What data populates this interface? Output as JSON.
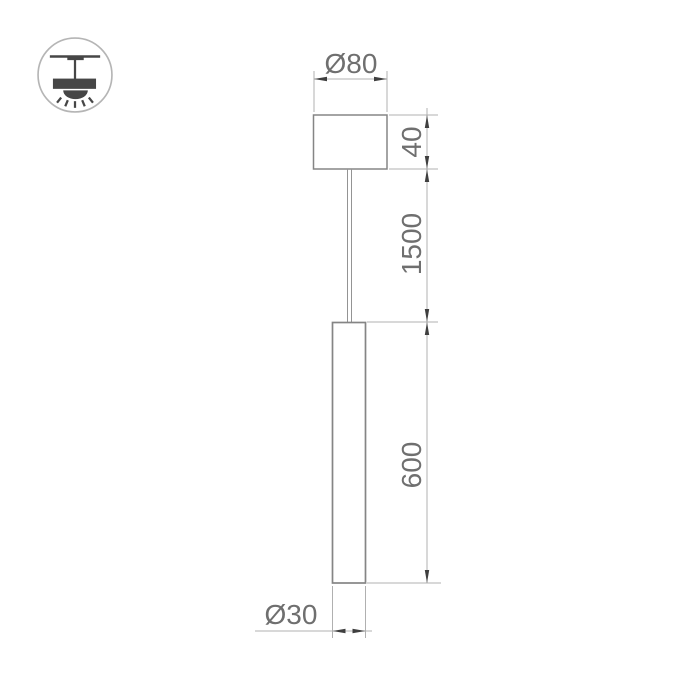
{
  "icon": {
    "badge": "pendant-lamp-icon"
  },
  "drawing": {
    "labels": {
      "canopy_diameter": "Ø80",
      "canopy_height": "40",
      "suspension_length": "1500",
      "tube_length": "600",
      "tube_diameter": "Ø30"
    },
    "colors": {
      "object_line": "#858585",
      "dimension_line": "#b0b0b0",
      "arrow": "#3f3f3f",
      "text": "#6f6f6f",
      "icon": "#464646",
      "icon_circle": "#b5b5b5"
    }
  }
}
